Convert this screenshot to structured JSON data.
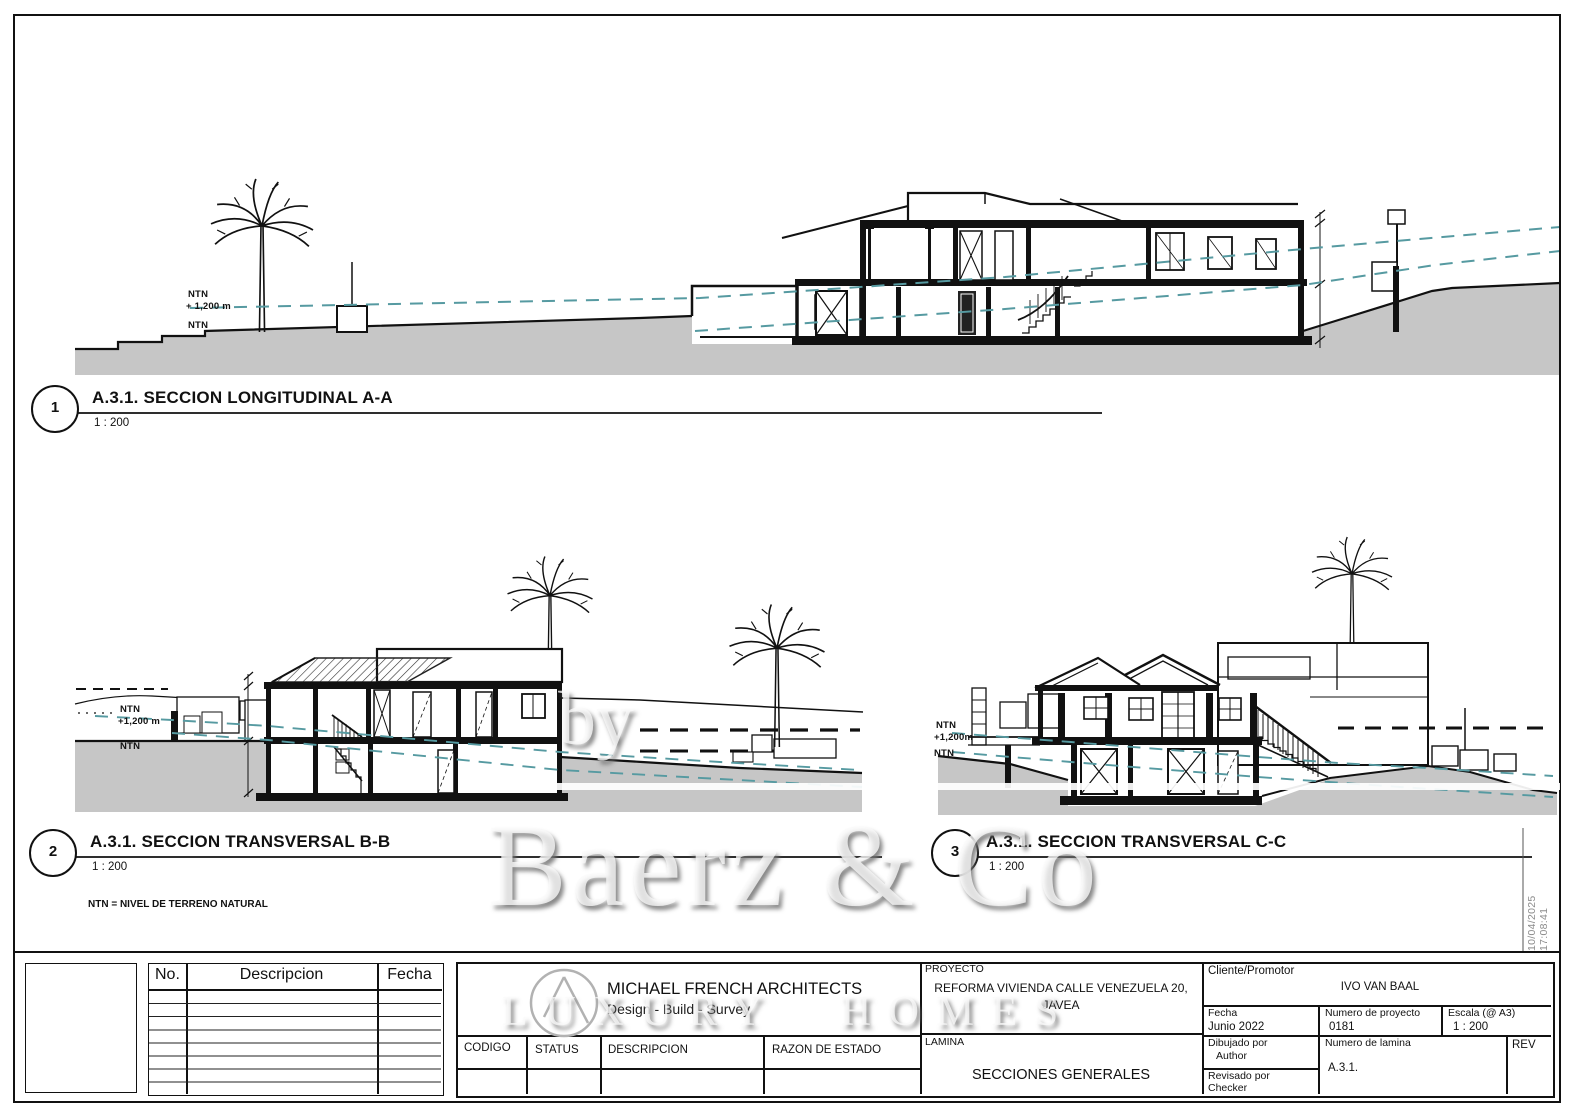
{
  "sheet": {
    "note": "NTN = NIVEL DE TERRENO NATURAL",
    "timestamp": "10/04/2025 17:08:41"
  },
  "sections": [
    {
      "number": "1",
      "title": "A.3.1. SECCION LONGITUDINAL A-A",
      "scale": "1 : 200",
      "ntn_top": "NTN",
      "level": "+ 1,200 m",
      "ntn_ground": "NTN"
    },
    {
      "number": "2",
      "title": "A.3.1. SECCION TRANSVERSAL B-B",
      "scale": "1 : 200",
      "ntn_top": "NTN",
      "level": "+1,200 m",
      "ntn_ground": "NTN"
    },
    {
      "number": "3",
      "title": "A.3.1. SECCION TRANSVERSAL C-C",
      "scale": "1 : 200",
      "ntn_top": "NTN",
      "level": "+1,200m",
      "ntn_ground": "NTN"
    }
  ],
  "watermark": {
    "by": "by",
    "name": "Baerz & Co",
    "tagline": "LUXURY HOMES"
  },
  "title_block": {
    "revision_table": {
      "col_no": "No.",
      "col_desc": "Descripcion",
      "col_fecha": "Fecha"
    },
    "firm": {
      "name": "MICHAEL FRENCH ARCHITECTS",
      "tagline": "Design - Build - Survey"
    },
    "status_row": {
      "codigo": "CODIGO",
      "status": "STATUS",
      "descripcion": "DESCRIPCION",
      "razon": "RAZON DE ESTADO"
    },
    "proyecto_label": "PROYECTO",
    "proyecto_line1": "REFORMA VIVIENDA CALLE VENEZUELA 20,",
    "proyecto_line2": "JAVEA",
    "lamina_label": "LAMINA",
    "lamina": "SECCIONES GENERALES",
    "cliente_label": "Cliente/Promotor",
    "cliente": "IVO VAN BAAL",
    "fecha_label": "Fecha",
    "fecha": "Junio 2022",
    "num_proyecto_label": "Numero de proyecto",
    "num_proyecto": "0181",
    "escala_label": "Escala (@ A3)",
    "escala": "1 : 200",
    "dibujado_label": "Dibujado por",
    "dibujado": "Author",
    "revisado_label": "Revisado por",
    "revisado": "Checker",
    "num_lamina_label": "Numero de lamina",
    "num_lamina": "A.3.1.",
    "rev_label": "REV"
  },
  "colors": {
    "ntn_line": "#569aa1",
    "ground": "#c6c6c6",
    "line": "#111111",
    "watermark_shadow": "#9a9a9a"
  }
}
